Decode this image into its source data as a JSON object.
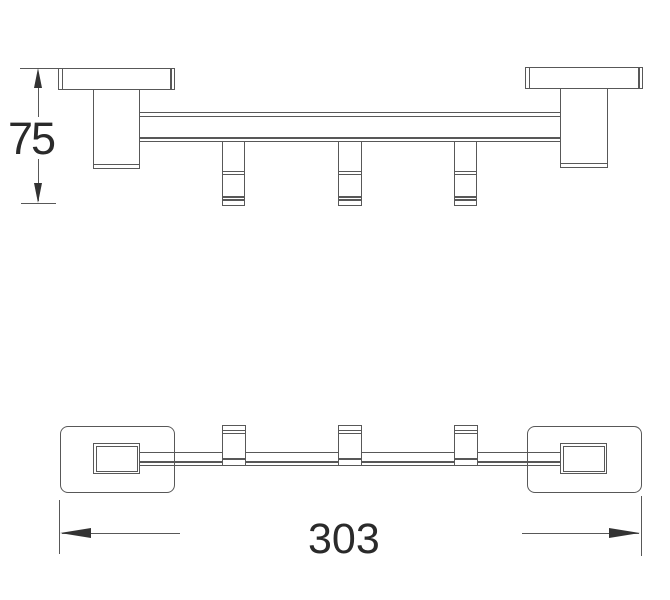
{
  "drawing": {
    "type": "technical-drawing",
    "subject": "wall-mounted rail with 3 hooks, two orthographic views",
    "hook_count": 3,
    "colors": {
      "line": "#585858",
      "text": "#2a2a2a",
      "arrow": "#333333",
      "background": "#ffffff"
    },
    "views": {
      "front": {
        "dimension": {
          "label": "75",
          "orientation": "vertical"
        }
      },
      "plan": {
        "dimension": {
          "label": "303",
          "orientation": "horizontal"
        }
      }
    }
  }
}
